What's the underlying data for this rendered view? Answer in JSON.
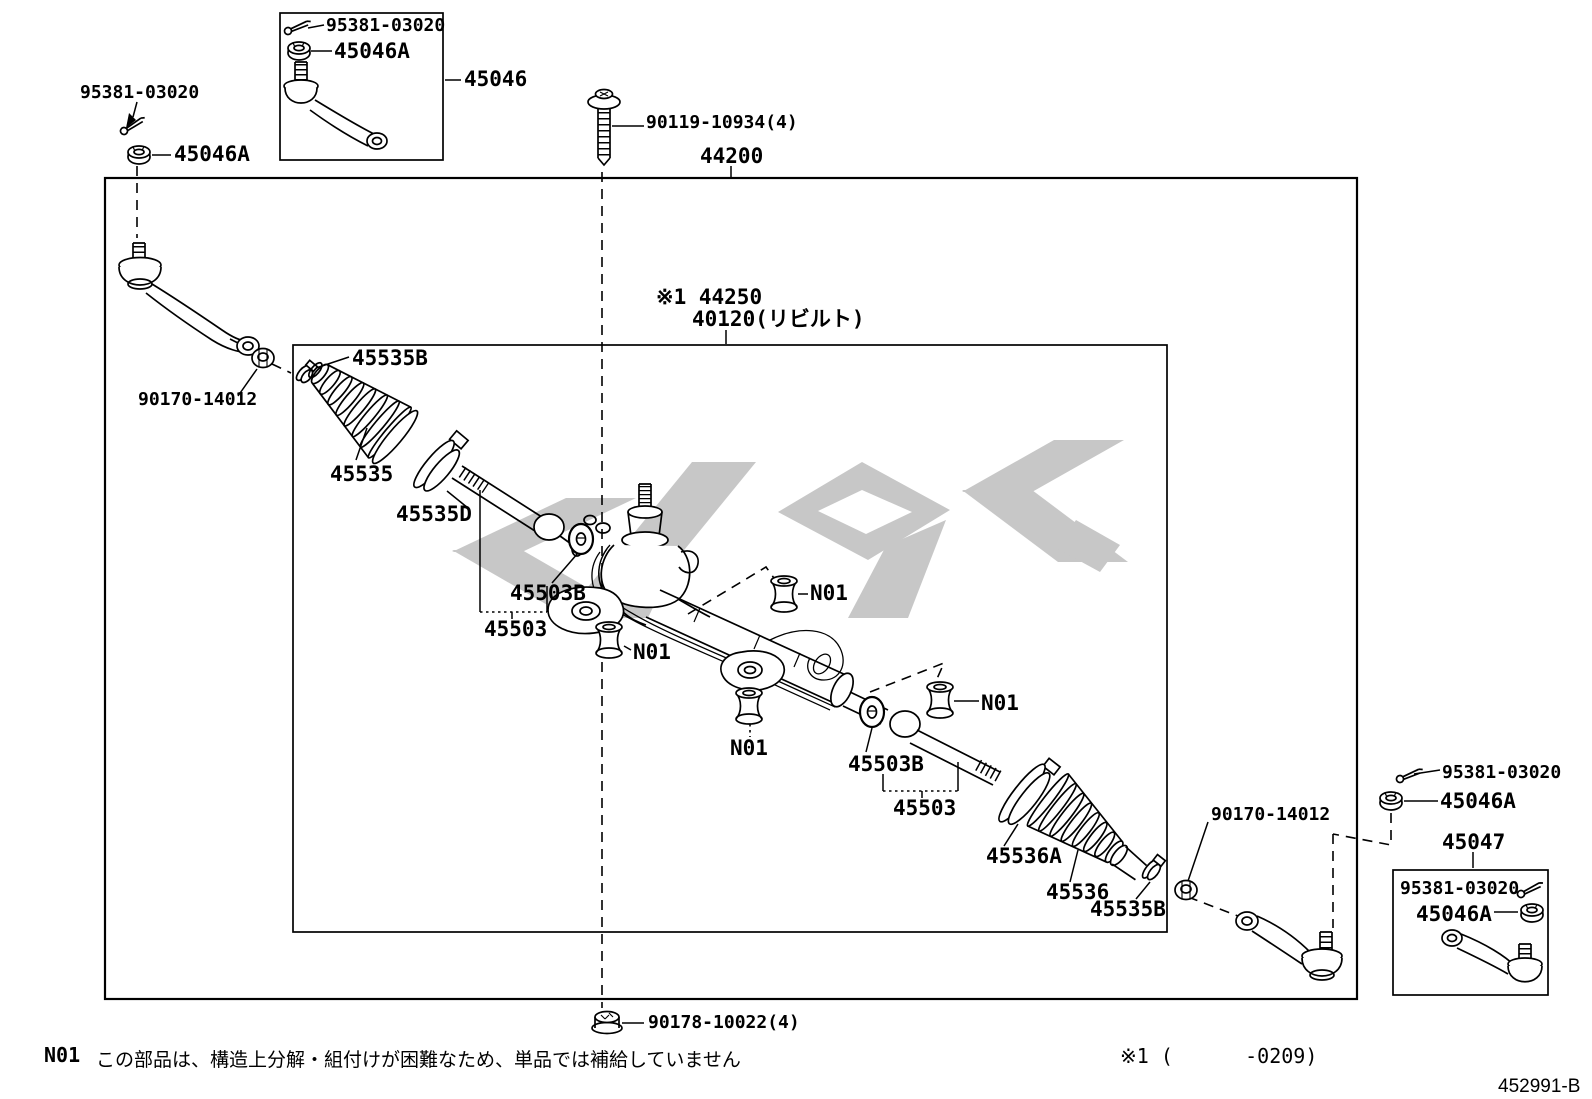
{
  "colors": {
    "line": "#000000",
    "background": "#ffffff",
    "watermark": "#c7c7c7"
  },
  "callouts": {
    "cotter_pin_top_left": "95381-03020",
    "castle_nut_top_left": "45046A",
    "inset_left_cotter_pin": "95381-03020",
    "inset_left_castle_nut": "45046A",
    "inset_left_tie_rod_end": "45046",
    "mount_bolt": "90119-10934(4)",
    "gear_assembly": "44200",
    "gear_assembly_note": "※1 44250",
    "gear_assembly_rebuilt": "40120(リビルト)",
    "boot_clamp_left": "45535B",
    "tie_rod_lock_nut_left": "90170-14012",
    "boot_left": "45535",
    "boot_clip_left": "45535D",
    "claw_washer_left": "45503B",
    "inner_tie_rod_left": "45503",
    "bushing_n01_left": "N01",
    "bushing_n01_top": "N01",
    "bushing_n01_center": "N01",
    "bushing_n01_right": "N01",
    "claw_washer_right": "45503B",
    "inner_tie_rod_right": "45503",
    "boot_clamp_right_large": "45536A",
    "boot_right": "45536",
    "boot_clamp_right_small": "45535B",
    "tie_rod_lock_nut_right": "90170-14012",
    "cotter_pin_right": "95381-03020",
    "castle_nut_right": "45046A",
    "inset_right_tie_rod_end": "45047",
    "inset_right_cotter_pin": "95381-03020",
    "inset_right_castle_nut": "45046A",
    "gear_set_nut": "90178-10022(4)"
  },
  "note": {
    "code": "N01",
    "text": "この部品は、構造上分解・組付けが困難なため、単品では補給していません"
  },
  "footer": {
    "applicability": "※1 (      -0209)",
    "figure_number": "452991-B"
  }
}
